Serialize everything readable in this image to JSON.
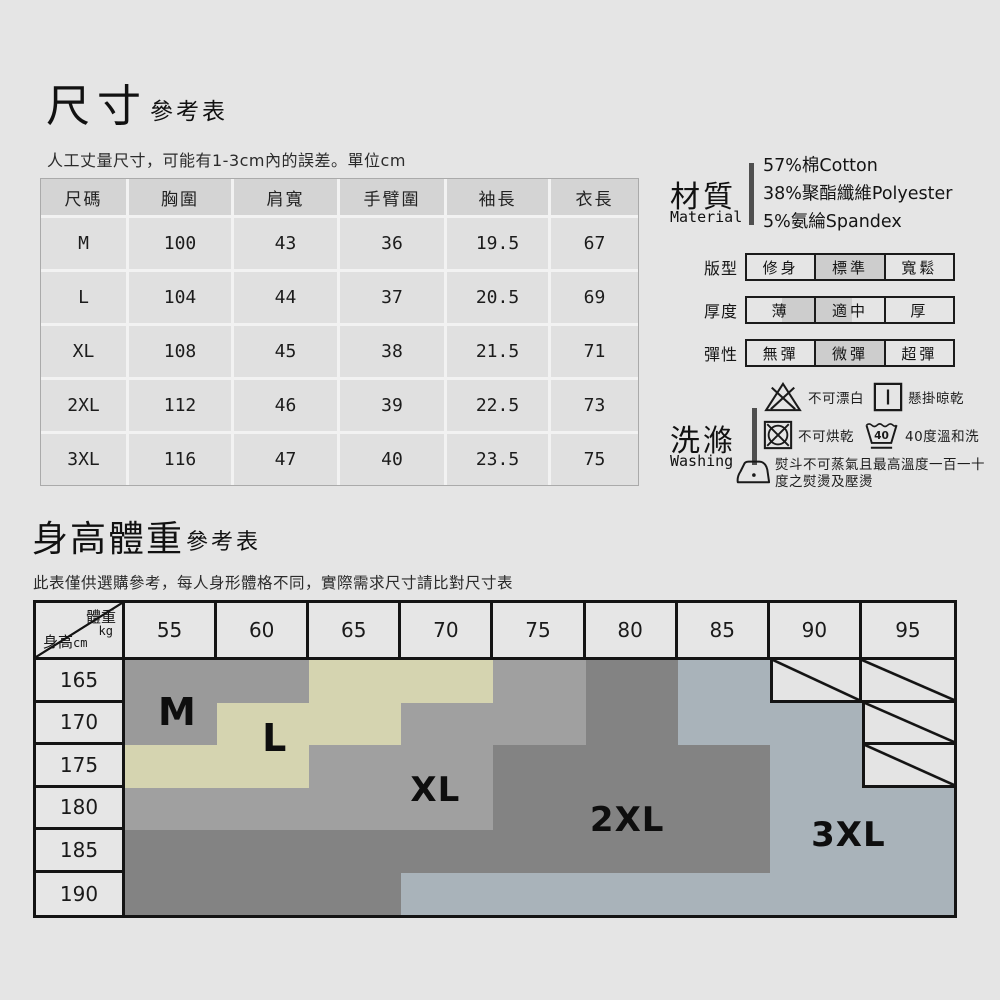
{
  "page": {
    "background": "#e5e5e5"
  },
  "size_section": {
    "title": "尺寸",
    "title_suffix": "參考表",
    "note": "人工丈量尺寸，可能有1-3cm內的誤差。單位cm",
    "table": {
      "headers": [
        "尺碼",
        "胸圍",
        "肩寬",
        "手臂圍",
        "袖長",
        "衣長"
      ],
      "rows": [
        [
          "M",
          "100",
          "43",
          "36",
          "19.5",
          "67"
        ],
        [
          "L",
          "104",
          "44",
          "37",
          "20.5",
          "69"
        ],
        [
          "XL",
          "108",
          "45",
          "38",
          "21.5",
          "71"
        ],
        [
          "2XL",
          "112",
          "46",
          "39",
          "22.5",
          "73"
        ],
        [
          "3XL",
          "116",
          "47",
          "40",
          "23.5",
          "75"
        ]
      ]
    }
  },
  "material_section": {
    "label_zh": "材質",
    "label_en": "Material",
    "lines": [
      "57%棉Cotton",
      "38%聚酯纖維Polyester",
      "5%氨綸Spandex"
    ]
  },
  "attributes": [
    {
      "label": "版型",
      "options": [
        "修身",
        "標準",
        "寬鬆"
      ],
      "highlight": {
        "type": "cell",
        "index": 1
      }
    },
    {
      "label": "厚度",
      "options": [
        "薄",
        "適中",
        "厚"
      ],
      "highlight": {
        "type": "span",
        "between": [
          0,
          1
        ]
      }
    },
    {
      "label": "彈性",
      "options": [
        "無彈",
        "微彈",
        "超彈"
      ],
      "highlight": {
        "type": "cell",
        "index": 1
      }
    }
  ],
  "washing_section": {
    "label_zh": "洗滌",
    "label_en": "Washing",
    "rows": [
      [
        {
          "icon": "no-bleach-icon",
          "text": "不可漂白"
        },
        {
          "icon": "hang-dry-icon",
          "text": "懸掛晾乾"
        }
      ],
      [
        {
          "icon": "no-tumble-dry-icon",
          "text": "不可烘乾"
        },
        {
          "icon": "wash-40-icon",
          "text": "40度溫和洗"
        }
      ],
      [
        {
          "icon": "iron-icon",
          "text": "熨斗不可蒸氣且最高溫度一百一十度之熨燙及壓燙"
        }
      ]
    ]
  },
  "hw_section": {
    "title": "身高體重",
    "title_suffix": "參考表",
    "note": "此表僅供選購參考，每人身形體格不同，實際需求尺寸請比對尺寸表",
    "corner": {
      "top": "體重",
      "top_unit": "kg",
      "bottom": "身高",
      "bottom_unit": "cm"
    },
    "weights": [
      "55",
      "60",
      "65",
      "70",
      "75",
      "80",
      "85",
      "90",
      "95"
    ],
    "heights": [
      "165",
      "170",
      "175",
      "180",
      "185",
      "190"
    ],
    "region_colors": {
      "M": "#9a9a9a",
      "L": "#d5d4b0",
      "XL": "#a0a0a0",
      "2XL": "#838383",
      "3XL": "#a9b3ba",
      "NA": "#e4e4e4"
    },
    "cells": [
      [
        "M",
        "M",
        "L",
        "L",
        "XL",
        "2XL",
        "3XL",
        "NA",
        "NA"
      ],
      [
        "M",
        "L",
        "L",
        "XL",
        "XL",
        "2XL",
        "3XL",
        "3XL",
        "NA"
      ],
      [
        "L",
        "L",
        "XL",
        "XL",
        "2XL",
        "2XL",
        "2XL",
        "3XL",
        "NA"
      ],
      [
        "XL",
        "XL",
        "XL",
        "XL",
        "2XL",
        "2XL",
        "2XL",
        "3XL",
        "3XL"
      ],
      [
        "2XL",
        "2XL",
        "2XL",
        "2XL",
        "2XL",
        "2XL",
        "2XL",
        "3XL",
        "3XL"
      ],
      [
        "2XL",
        "2XL",
        "2XL",
        "3XL",
        "3XL",
        "3XL",
        "3XL",
        "3XL",
        "3XL"
      ]
    ],
    "labels": [
      {
        "text": "M",
        "left": "15.4%",
        "top": "35%",
        "size": 38
      },
      {
        "text": "L",
        "left": "26%",
        "top": "43.2%",
        "size": 38
      },
      {
        "text": "XL",
        "left": "43.5%",
        "top": "60%",
        "size": 34
      },
      {
        "text": "2XL",
        "left": "64.4%",
        "top": "69.5%",
        "size": 34
      },
      {
        "text": "3XL",
        "left": "88.5%",
        "top": "74.5%",
        "size": 34
      }
    ]
  }
}
